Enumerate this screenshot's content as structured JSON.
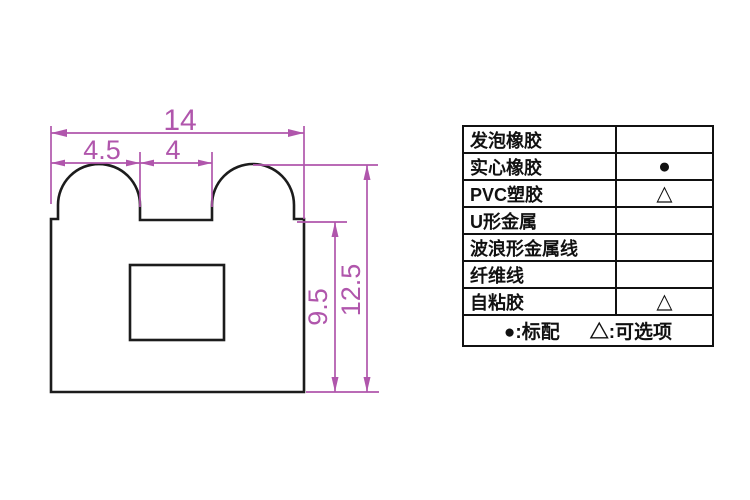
{
  "drawing": {
    "title": "seal-profile-cross-section",
    "dimensions": {
      "total_width": "14",
      "left_bump_width": "4.5",
      "valley_width": "4",
      "inner_height": "9.5",
      "total_height": "12.5"
    },
    "colors": {
      "dimension_lines": "#b056ac",
      "profile_outline": "#1c1c1c",
      "table_border": "#111111"
    }
  },
  "table": {
    "rows": [
      {
        "label": "发泡橡胶",
        "symbol": ""
      },
      {
        "label": "实心橡胶",
        "symbol": "●"
      },
      {
        "label": "PVC塑胶",
        "symbol": "△"
      },
      {
        "label": "U形金属",
        "symbol": ""
      },
      {
        "label": "波浪形金属线",
        "symbol": ""
      },
      {
        "label": "纤维线",
        "symbol": ""
      },
      {
        "label": "自粘胶",
        "symbol": "△"
      }
    ],
    "legend": {
      "standard": "●:标配",
      "optional": "△:可选项"
    }
  }
}
